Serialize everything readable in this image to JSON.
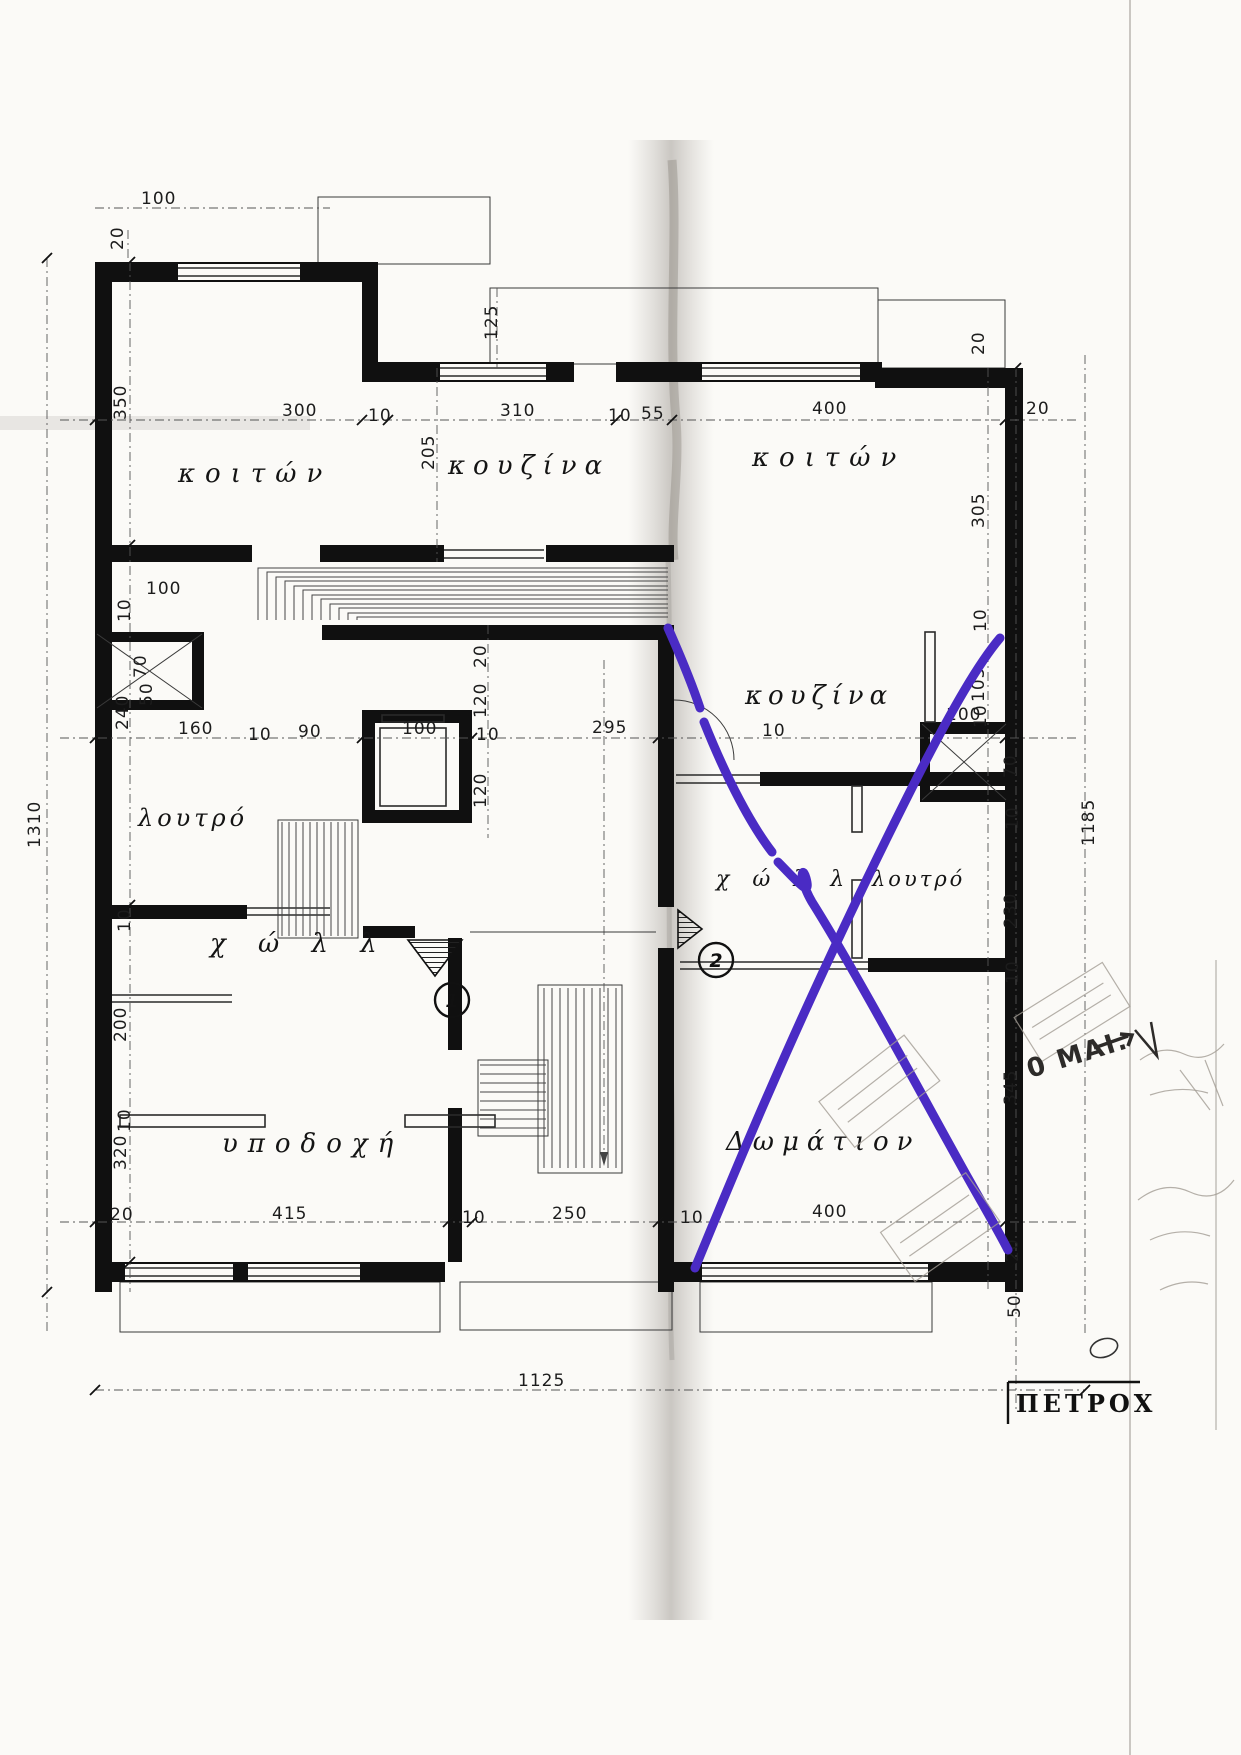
{
  "rooms": {
    "bedroom_left": "κοιτών",
    "kitchen_top": "κουζίνα",
    "bedroom_right": "κοιτών",
    "bathroom_left": "λουτρό",
    "kitchen_right": "κουζίνα",
    "hall_left": "χ ώ λ λ",
    "hall_right": "χ ώ λ λ",
    "bathroom_right": "λουτρό",
    "reception": "υποδοχή",
    "room_bottom_right": "Δωμάτιον"
  },
  "markers": {
    "entrance_1": "1",
    "entrance_2": "2"
  },
  "stamp": {
    "date_fragment": "0 MAI."
  },
  "sheet": {
    "title_block_text": "ΠΕΤΡΟΧ"
  },
  "colors": {
    "annotation_purple": "#4a2bc4",
    "ink": "#101010",
    "paper": "#fbfaf7"
  },
  "dims": {
    "top_100": "100",
    "top_20": "20",
    "top_125": "125",
    "row1_300": "300",
    "row1_10a": "10",
    "row1_310": "310",
    "row1_10b": "10",
    "row1_55": "55",
    "row1_400": "400",
    "row1_20": "20",
    "left_350": "350",
    "kitchen_205": "205",
    "right_20top": "20",
    "right_305": "305",
    "shaft_left_10": "10",
    "shaft_left_100": "100",
    "shaft_left_70": "70",
    "shaft_left_50": "50",
    "row2_160": "160",
    "row2_10a": "10",
    "row2_90": "90",
    "row2_100": "100",
    "row2_10b": "10",
    "row2_295": "295",
    "row2_10c": "10",
    "elev_20": "20",
    "elev_120a": "120",
    "elev_120b": "120",
    "left_240": "240",
    "left_10b": "10",
    "left_200": "200",
    "left_10c": "10",
    "left_320": "320",
    "right_10a": "10",
    "right_105": "105",
    "right_10b": "10",
    "shaft_right_100": "100",
    "shaft_right_70": "70",
    "right_10c": "10",
    "right_230": "230",
    "right_10d": "10",
    "right_345": "345",
    "right_20b": "20",
    "right_50": "50",
    "row3_20": "20",
    "row3_415": "415",
    "row3_10a": "10",
    "row3_250": "250",
    "row3_10b": "10",
    "row3_400": "400",
    "total_width": "1125",
    "total_left": "1310",
    "total_right": "1185"
  }
}
